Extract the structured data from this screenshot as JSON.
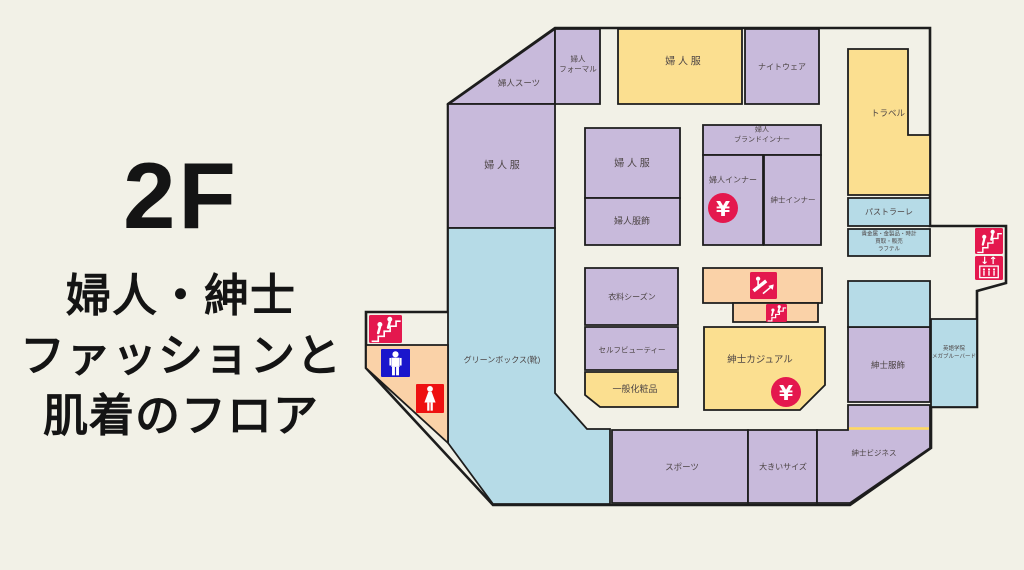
{
  "page": {
    "background": "#f2f1e7"
  },
  "header": {
    "floor": "2F",
    "lines": [
      "婦人・紳士",
      "ファッションと",
      "肌着のフロア"
    ]
  },
  "map": {
    "colors": {
      "floor": "#f2f1e7",
      "wall": "#1d1d1d",
      "label": "#4d4545",
      "purple": "#c8badb",
      "yellow": "#fbdf90",
      "blue": "#b6dbe7",
      "peach": "#fad2a8",
      "crimson": "#e4184e",
      "red": "#ee1111",
      "blue_icon": "#1a16cc",
      "accent_yellow": "#ffd95e",
      "icon_glyph": "#ffffff"
    },
    "outline": "555,28 930,28 930,226 1006,226 1006,283 977,291 977,407 931,407 931,448 850,505 493,505 366,368 366,312 448,312 448,104",
    "rooms": [
      {
        "name": "fujin-suit",
        "label": [
          "婦人スーツ"
        ],
        "color": "purple",
        "points": "449,104 555,29 555,104",
        "lx": 519,
        "ly": 83,
        "fs": 8.5
      },
      {
        "name": "fujin-formal",
        "label": [
          "婦人",
          "フォーマル"
        ],
        "color": "purple",
        "points": "555,29 600,29 600,104 555,104",
        "lx": 578,
        "ly": 64,
        "fs": 7.5
      },
      {
        "name": "fujin-fuku-north",
        "label": [
          "婦 人 服"
        ],
        "color": "yellow",
        "points": "618,29 742,29 742,104 618,104",
        "lx": 683,
        "ly": 62,
        "fs": 10
      },
      {
        "name": "nightwear",
        "label": [
          "ナイトウェア"
        ],
        "color": "purple",
        "points": "745,29 819,29 819,104 745,104",
        "lx": 782,
        "ly": 67,
        "fs": 8
      },
      {
        "name": "travel",
        "label": [
          "トラベル"
        ],
        "color": "yellow",
        "points": "848,49 908,49 908,135 930,135 930,195 848,195",
        "lx": 888,
        "ly": 113,
        "fs": 8.5
      },
      {
        "name": "fujin-fuku-west",
        "label": [
          "婦 人 服"
        ],
        "color": "purple",
        "points": "448,104 555,104 555,228 448,228",
        "lx": 502,
        "ly": 166,
        "fs": 10
      },
      {
        "name": "fujin-fuku-center",
        "label": [
          "婦 人 服"
        ],
        "color": "purple",
        "points": "585,128 680,128 680,198 585,198",
        "lx": 632,
        "ly": 164,
        "fs": 10
      },
      {
        "name": "fujin-fukushoku",
        "label": [
          "婦人服飾"
        ],
        "color": "purple",
        "points": "585,198 680,198 680,245 585,245",
        "lx": 632,
        "ly": 221,
        "fs": 9
      },
      {
        "name": "fujin-brand-inner",
        "label": [
          "婦人",
          "ブランドインナー"
        ],
        "color": "purple",
        "points": "703,125 821,125 821,155 703,155",
        "lx": 762,
        "ly": 135,
        "fs": 7
      },
      {
        "name": "fujin-inner",
        "label": [
          "婦人インナー"
        ],
        "color": "purple",
        "points": "703,155 763,155 763,245 703,245",
        "lx": 733,
        "ly": 180,
        "fs": 8
      },
      {
        "name": "shinshi-inner",
        "label": [
          "紳士インナー"
        ],
        "color": "purple",
        "points": "764,155 821,155 821,245 764,245",
        "lx": 793,
        "ly": 200,
        "fs": 7.5
      },
      {
        "name": "pastorale",
        "label": [
          "パストラーレ"
        ],
        "color": "blue",
        "points": "848,198 930,198 930,226 848,226",
        "lx": 889,
        "ly": 212,
        "fs": 8
      },
      {
        "name": "kikinzoku",
        "label": [
          "貴金属・金製品・時計",
          "買取・販売",
          "ラフテル"
        ],
        "color": "blue",
        "points": "848,229 930,229 930,256 848,256",
        "lx": 889,
        "ly": 242,
        "fs": 5.5
      },
      {
        "name": "iryo-season",
        "label": [
          "衣料シーズン"
        ],
        "color": "purple",
        "points": "585,268 678,268 678,325 585,325",
        "lx": 632,
        "ly": 297,
        "fs": 8
      },
      {
        "name": "self-beauty",
        "label": [
          "セルフビューティー"
        ],
        "color": "purple",
        "points": "585,327 678,327 678,370 585,370",
        "lx": 632,
        "ly": 350,
        "fs": 7.5
      },
      {
        "name": "ippan-keshohin",
        "label": [
          "一般化粧品"
        ],
        "color": "yellow",
        "points": "585,372 678,372 678,407 600,407 585,395",
        "lx": 635,
        "ly": 389,
        "fs": 9
      },
      {
        "name": "escalator-hall",
        "label": [],
        "color": "peach",
        "points": "703,268 822,268 822,303 703,303"
      },
      {
        "name": "escalator-hall-south",
        "label": [],
        "color": "peach",
        "points": "733,303 818,303 818,322 733,322"
      },
      {
        "name": "shinshi-casual",
        "label": [
          "紳士カジュアル"
        ],
        "color": "yellow",
        "points": "704,327 825,327 825,385 800,410 704,410",
        "lx": 760,
        "ly": 360,
        "fs": 9.5
      },
      {
        "name": "greenbox",
        "label": [
          "グリーンボックス(靴)"
        ],
        "color": "blue",
        "points": "448,228 555,228 555,393 587,429 610,429 610,504 493,504 448,443",
        "lx": 502,
        "ly": 360,
        "fs": 8
      },
      {
        "name": "restroom-area",
        "label": [],
        "color": "peach",
        "points": "366,345 448,345 448,443 366,368"
      },
      {
        "name": "sports",
        "label": [
          "スポーツ"
        ],
        "color": "purple",
        "points": "612,430 748,430 748,503 612,503",
        "lx": 682,
        "ly": 467,
        "fs": 8.5
      },
      {
        "name": "large-size",
        "label": [
          "大きいサイズ"
        ],
        "color": "purple",
        "points": "748,430 817,430 817,503 748,503",
        "lx": 783,
        "ly": 467,
        "fs": 8
      },
      {
        "name": "shinshi-business",
        "label": [
          "紳士ビジネス"
        ],
        "color": "purple",
        "points": "817,430 848,430 848,405 930,405 930,448 850,503 817,503",
        "lx": 874,
        "ly": 453,
        "fs": 7.5
      },
      {
        "name": "shinshi-fukushoku",
        "label": [
          "紳士服飾"
        ],
        "color": "purple",
        "points": "848,327 930,327 930,402 848,402",
        "lx": 888,
        "ly": 365,
        "fs": 8.5
      },
      {
        "name": "tenant-blue",
        "label": [],
        "color": "blue",
        "points": "848,281 930,281 930,327 848,327"
      },
      {
        "name": "megabluebird",
        "label": [
          "英語学院",
          "メガブルーバード"
        ],
        "color": "blue",
        "points": "931,319 977,319 977,407 931,407",
        "lx": 954,
        "ly": 353,
        "fs": 5.5
      }
    ],
    "accent_lines": [
      {
        "name": "shinshi-business-divider",
        "x1": 849,
        "y1": 428.5,
        "x2": 929,
        "y2": 428.5
      }
    ],
    "icons": [
      {
        "type": "stairs",
        "name": "stairs-icon-west",
        "x": 369,
        "y": 315,
        "w": 33,
        "h": 28
      },
      {
        "type": "mens",
        "name": "mens-room-icon",
        "x": 381,
        "y": 349,
        "w": 29,
        "h": 28
      },
      {
        "type": "womens",
        "name": "womens-room-icon",
        "x": 416,
        "y": 384,
        "w": 28,
        "h": 29
      },
      {
        "type": "escalator",
        "name": "escalator-icon",
        "x": 750,
        "y": 272,
        "w": 27,
        "h": 27
      },
      {
        "type": "stairs",
        "name": "stairs-icon-center",
        "x": 766,
        "y": 304,
        "w": 21,
        "h": 18
      },
      {
        "type": "yen",
        "name": "yen-icon-fujin-inner",
        "cx": 723,
        "cy": 208,
        "r": 15
      },
      {
        "type": "yen",
        "name": "yen-icon-shinshi-casual",
        "cx": 786,
        "cy": 392,
        "r": 15
      },
      {
        "type": "stairs",
        "name": "stairs-icon-east",
        "x": 975,
        "y": 228,
        "w": 28,
        "h": 26
      },
      {
        "type": "elevator",
        "name": "elevator-icon",
        "x": 975,
        "y": 256,
        "w": 28,
        "h": 24
      }
    ]
  }
}
